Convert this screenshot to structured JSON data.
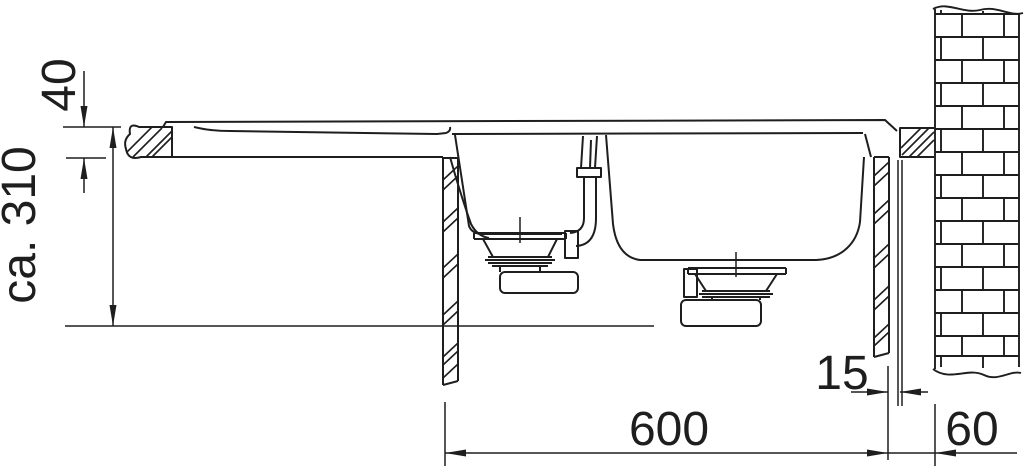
{
  "drawing": {
    "background_color": "#ffffff",
    "line_color": "#1e1e1e",
    "dimensions": {
      "countertop_thickness": {
        "label": "40"
      },
      "installation_depth": {
        "label": "ca. 310"
      },
      "rear_gap": {
        "label": "15"
      },
      "cabinet_width": {
        "label": "600"
      },
      "wall_offset": {
        "label": "60"
      }
    }
  }
}
